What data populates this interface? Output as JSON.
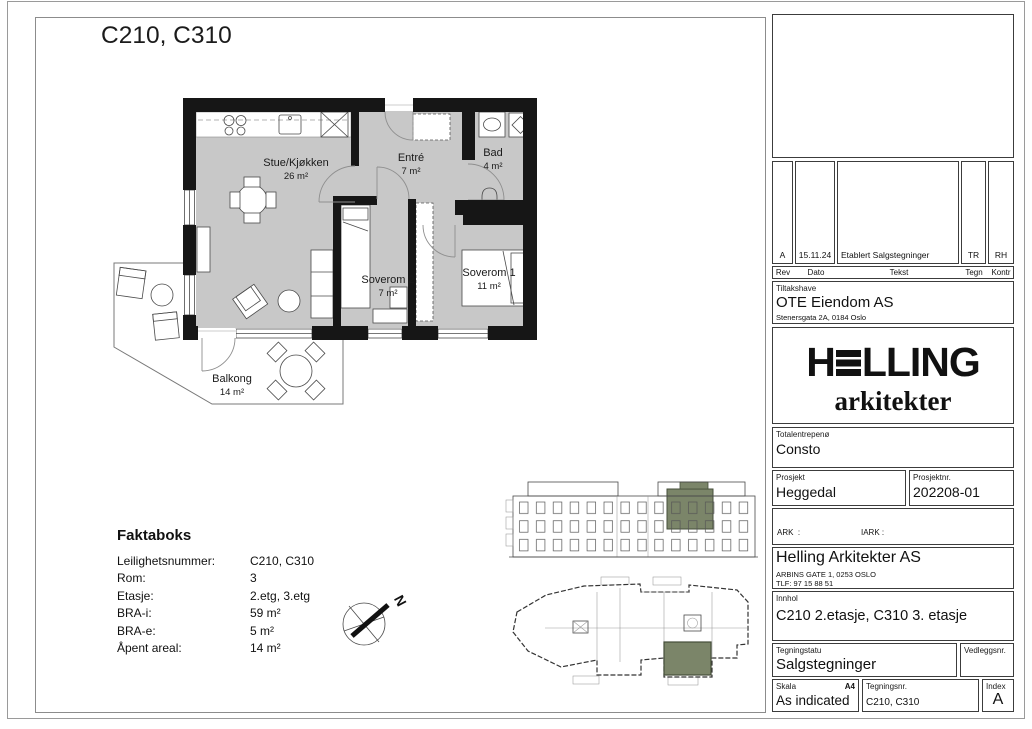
{
  "sheet": {
    "title": "C210, C310"
  },
  "floor_plan": {
    "north_label": "N",
    "rooms": [
      {
        "name": "Stue/Kjøkken",
        "area": "26 m²"
      },
      {
        "name": "Entré",
        "area": "7 m²"
      },
      {
        "name": "Bad",
        "area": "4 m²"
      },
      {
        "name": "Soverom 2",
        "area": "7 m²"
      },
      {
        "name": "Soverom 1",
        "area": "11 m²"
      },
      {
        "name": "Balkong",
        "area": "14 m²"
      }
    ]
  },
  "faktaboks": {
    "title": "Faktaboks",
    "rows": [
      {
        "label": "Leilighetsnummer:",
        "value": "C210, C310"
      },
      {
        "label": "Rom:",
        "value": "3"
      },
      {
        "label": "Etasje:",
        "value": "2.etg, 3.etg"
      },
      {
        "label": "BRA-i:",
        "value": "59 m²"
      },
      {
        "label": "BRA-e:",
        "value": "5 m²"
      },
      {
        "label": "Åpent areal:",
        "value": "14 m²"
      }
    ]
  },
  "title_block": {
    "revision": {
      "headers": {
        "rev": "Rev",
        "dato": "Dato",
        "tekst": "Tekst",
        "tegn": "Tegn",
        "kontr": "Kontr"
      },
      "row": {
        "rev": "A",
        "dato": "15.11.24",
        "tekst": "Etablert Salgstegninger",
        "tegn": "TR",
        "kontr": "RH"
      }
    },
    "tiltakshaver": {
      "label": "Tiltakshave",
      "name": "OTE Eiendom AS",
      "address": "Stenersgata 2A, 0184 Oslo"
    },
    "logo": {
      "h": "H",
      "rest": "LLING",
      "sub": "arkitekter"
    },
    "totalentreprenor": {
      "label": "Totalentrepenø",
      "value": "Consto"
    },
    "prosjekt": {
      "label": "Prosjekt",
      "value": "Heggedal"
    },
    "prosjektnr": {
      "label": "Prosjektnr.",
      "value": "202208-01"
    },
    "consultants": {
      "col1": [
        "ARK  :",
        "RIB   :",
        "RIE   :",
        "RIV   :"
      ],
      "col2": [
        "IARK :",
        "RIBr  :",
        "EL     :",
        "VENT:"
      ]
    },
    "architect": {
      "name": "Helling Arkitekter AS",
      "address": "ARBINS GATE 1, 0253 OSLO",
      "phone": "TLF: 97 15 88 51"
    },
    "innhold": {
      "label": "Innhol",
      "value": "C210 2.etasje, C310 3. etasje"
    },
    "tegningsstatus": {
      "label": "Tegningstatu",
      "value": "Salgstegninger"
    },
    "vedleggsnr": {
      "label": "Vedleggsnr."
    },
    "skala": {
      "label": "Skala",
      "format": "A4",
      "value": "As indicated"
    },
    "tegningsnr": {
      "label": "Tegningsnr.",
      "value": "C210, C310"
    },
    "index": {
      "label": "Index",
      "value": "A"
    }
  },
  "colors": {
    "floor": "#c8c8c8",
    "wall": "#161616",
    "highlight": "#7b8569",
    "highlight_border": "#454e3a"
  }
}
